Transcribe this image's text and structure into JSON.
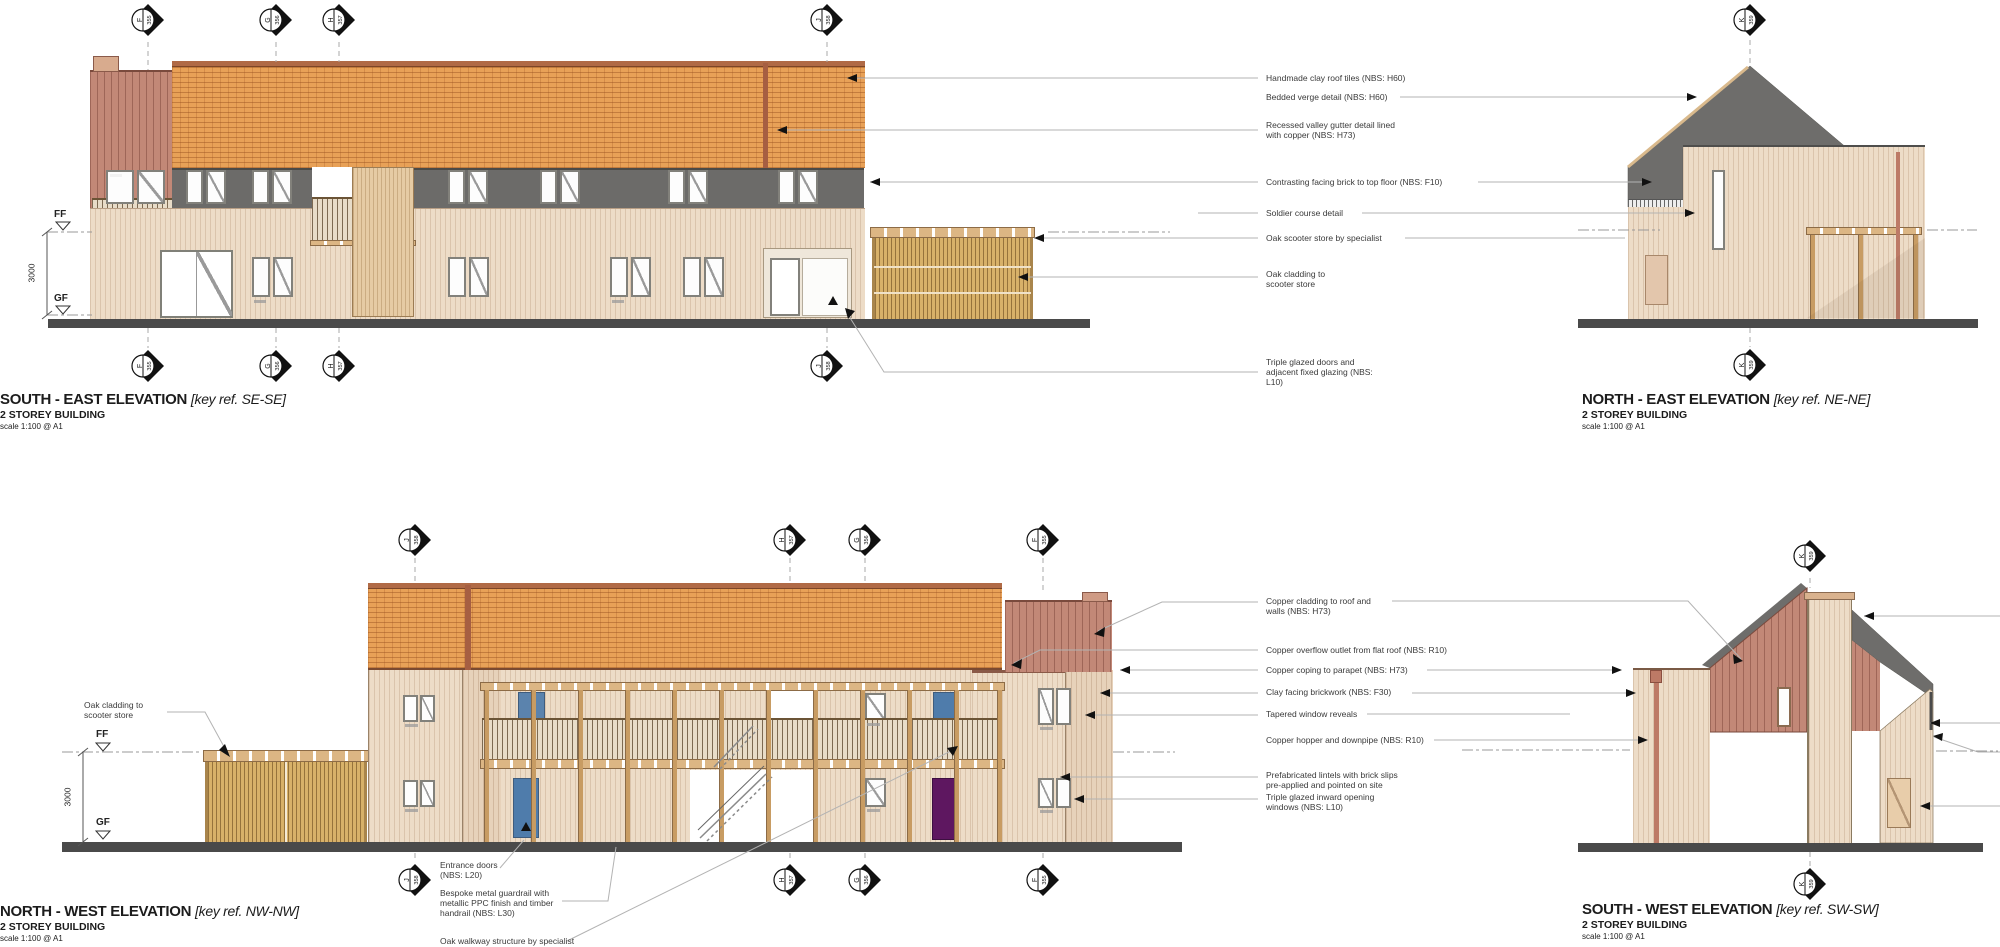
{
  "drawing": {
    "elevations": {
      "se": {
        "title": "SOUTH - EAST ELEVATION",
        "key_ref": "[key ref. SE-SE]",
        "subtitle": "2 STOREY BUILDING",
        "scale": "scale 1:100 @ A1"
      },
      "ne": {
        "title": "NORTH - EAST ELEVATION",
        "key_ref": "[key ref. NE-NE]",
        "subtitle": "2 STOREY BUILDING",
        "scale": "scale 1:100 @ A1"
      },
      "nw": {
        "title": "NORTH - WEST ELEVATION",
        "key_ref": "[key ref. NW-NW]",
        "subtitle": "2 STOREY BUILDING",
        "scale": "scale 1:100 @ A1"
      },
      "sw": {
        "title": "SOUTH - WEST ELEVATION",
        "key_ref": "[key ref. SW-SW]",
        "subtitle": "2 STOREY BUILDING",
        "scale": "scale 1:100 @ A1"
      }
    },
    "levels": {
      "ff": "FF",
      "gf": "GF",
      "storey_height": "3000"
    },
    "grid_markers": {
      "f": {
        "letter": "F",
        "number": "355"
      },
      "g": {
        "letter": "G",
        "number": "356"
      },
      "h": {
        "letter": "H",
        "number": "357"
      },
      "j": {
        "letter": "J",
        "number": "358"
      },
      "k": {
        "letter": "K",
        "number": "359"
      }
    },
    "annotations": {
      "top_right": [
        {
          "text": "Handmade clay roof tiles (NBS: H60)"
        },
        {
          "text": "Bedded verge detail (NBS: H60)"
        },
        {
          "text": "Recessed valley gutter detail lined\nwith copper (NBS: H73)"
        },
        {
          "text": "Contrasting facing brick to top floor (NBS: F10)"
        },
        {
          "text": "Soldier course detail"
        },
        {
          "text": "Oak scooter store by specialist"
        },
        {
          "text": "Oak cladding to\nscooter store"
        },
        {
          "text": "Triple glazed doors and\nadjacent fixed glazing (NBS:\nL10)"
        }
      ],
      "middle_right": [
        {
          "text": "Copper cladding to roof and\nwalls (NBS: H73)"
        },
        {
          "text": "Copper overflow outlet from flat roof (NBS: R10)"
        },
        {
          "text": "Copper coping to parapet (NBS: H73)"
        },
        {
          "text": "Clay facing brickwork (NBS: F30)"
        },
        {
          "text": "Tapered window reveals"
        },
        {
          "text": "Copper hopper and downpipe (NBS: R10)"
        },
        {
          "text": "Prefabricated lintels with brick slips\npre-applied and pointed on site"
        },
        {
          "text": "Triple glazed inward opening\nwindows (NBS: L10)"
        }
      ],
      "nw_side": [
        {
          "text": "Oak cladding to\nscooter store"
        },
        {
          "text": "Entrance doors\n(NBS: L20)"
        },
        {
          "text": "Bespoke metal guardrail with\nmetallic PPC finish and timber\nhandrail (NBS: L30)"
        },
        {
          "text": "Oak walkway structure by specialist"
        }
      ]
    },
    "colors": {
      "roof_tile": "#e8a157",
      "copper": "#c28877",
      "oak": "#d8b169",
      "wall_cream": "#eddcc7",
      "dark_band": "#6c6b69",
      "roof_gray": "#6e6d6b",
      "ground": "#4a4a4a",
      "door_blue": "#4f7cab",
      "door_purple": "#5e1760"
    }
  }
}
